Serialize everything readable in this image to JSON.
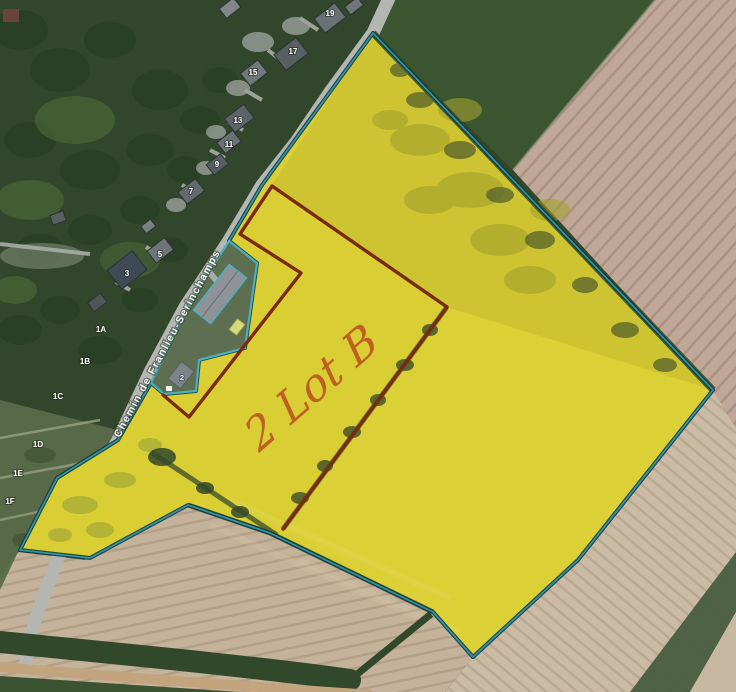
{
  "map": {
    "road_label": "Chemin de Franlieu-Serinchamps",
    "annotation": {
      "text": "2 Lot B"
    },
    "excluded_parcel_label": "2",
    "house_numbers": [
      {
        "label": "19",
        "x": 330,
        "y": 16
      },
      {
        "label": "17",
        "x": 293,
        "y": 54
      },
      {
        "label": "15",
        "x": 253,
        "y": 75
      },
      {
        "label": "13",
        "x": 238,
        "y": 123
      },
      {
        "label": "11",
        "x": 229,
        "y": 147
      },
      {
        "label": "9",
        "x": 217,
        "y": 167
      },
      {
        "label": "7",
        "x": 191,
        "y": 194
      },
      {
        "label": "5",
        "x": 160,
        "y": 257
      },
      {
        "label": "3",
        "x": 127,
        "y": 276
      },
      {
        "label": "1A",
        "x": 101,
        "y": 332
      },
      {
        "label": "1B",
        "x": 85,
        "y": 364
      },
      {
        "label": "1C",
        "x": 58,
        "y": 399
      },
      {
        "label": "1D",
        "x": 38,
        "y": 447
      },
      {
        "label": "1E",
        "x": 18,
        "y": 476
      },
      {
        "label": "1F",
        "x": 10,
        "y": 504
      }
    ],
    "colors": {
      "parcel_fill": "#d9ce33",
      "parcel_outline_teal": "#2f93a6",
      "parcel_outline_shadow": "#12343a",
      "lot_boundary_red": "#7a2a10",
      "annotation_orange": "#bd5620",
      "excluded_outline_teal": "#49b0c0",
      "road_gray": "#b3b6b1"
    }
  }
}
